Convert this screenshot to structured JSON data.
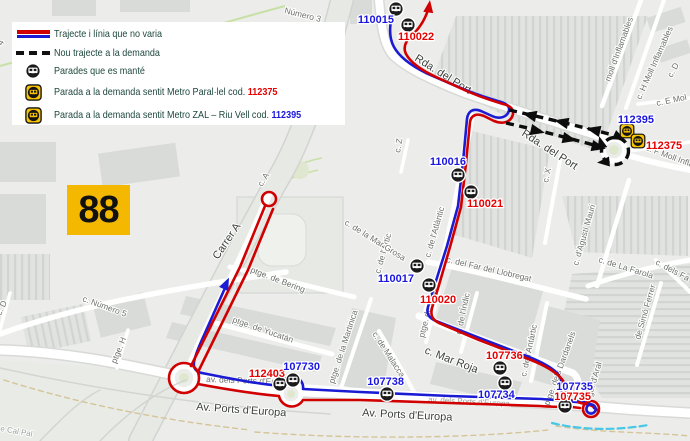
{
  "route_number": "88",
  "colors": {
    "line_red": "#d10000",
    "line_blue": "#1b1bd4",
    "label_red": "#e60000",
    "label_blue": "#1a16e0",
    "badge_yellow": "#f5b800",
    "legend_text": "#1d473c",
    "demand_black": "#0d0d0d",
    "demand_stop_yellow": "#f8c300"
  },
  "legend": {
    "items": [
      {
        "swatch": "double-line",
        "label": "Trajecte i línia que no varia"
      },
      {
        "swatch": "dashed-line",
        "label": "Nou trajecte a la demanda"
      },
      {
        "swatch": "kept-stop",
        "label": "Parades que es manté"
      },
      {
        "swatch": "demand-stop",
        "label": "Parada a la demanda sentit Metro Paral·lel cod. ",
        "code": "112375",
        "code_color": "#e60000"
      },
      {
        "swatch": "demand-stop",
        "label": "Parada a la demanda sentit Metro ZAL – Riu Vell cod. ",
        "code": "112395",
        "code_color": "#1a16e0"
      }
    ]
  },
  "map": {
    "stops": [
      {
        "code": "110015",
        "color": "blue",
        "type": "kept",
        "x": 396,
        "y": 9,
        "lx": 394,
        "ly": 23,
        "anchor": "end"
      },
      {
        "code": "110022",
        "color": "red",
        "type": "kept",
        "x": 408,
        "y": 25,
        "lx": 398,
        "ly": 40,
        "anchor": "start"
      },
      {
        "code": "110016",
        "color": "blue",
        "type": "kept",
        "x": 458,
        "y": 175,
        "lx": 466,
        "ly": 165,
        "anchor": "end"
      },
      {
        "code": "110021",
        "color": "red",
        "type": "kept",
        "x": 471,
        "y": 192,
        "lx": 467,
        "ly": 207,
        "anchor": "start"
      },
      {
        "code": "110017",
        "color": "blue",
        "type": "kept",
        "x": 417,
        "y": 266,
        "lx": 414,
        "ly": 282,
        "anchor": "end"
      },
      {
        "code": "110020",
        "color": "red",
        "type": "kept",
        "x": 429,
        "y": 285,
        "lx": 420,
        "ly": 303,
        "anchor": "start"
      },
      {
        "code": "107736",
        "color": "red",
        "type": "kept",
        "x": 500,
        "y": 368,
        "lx": 486,
        "ly": 359,
        "anchor": "start"
      },
      {
        "code": "107734",
        "color": "blue",
        "type": "kept",
        "x": 505,
        "y": 383,
        "lx": 478,
        "ly": 398,
        "anchor": "start"
      },
      {
        "code": "107738",
        "color": "blue",
        "type": "kept",
        "x": 387,
        "y": 394,
        "lx": 404,
        "ly": 385,
        "anchor": "end"
      },
      {
        "code": "112403",
        "color": "red",
        "type": "kept",
        "x": 280,
        "y": 384,
        "lx": 285,
        "ly": 377,
        "anchor": "end"
      },
      {
        "code": "107730",
        "color": "blue",
        "type": "kept",
        "x": 293,
        "y": 380,
        "lx": 320,
        "ly": 370,
        "anchor": "end"
      },
      {
        "code": "107735",
        "color": "blue",
        "type": "none",
        "x": 565,
        "y": 406,
        "lx": 593,
        "ly": 390,
        "anchor": "end",
        "no_icon": true
      },
      {
        "code": "107735",
        "color": "red",
        "type": "kept",
        "x": 565,
        "y": 406,
        "lx": 591,
        "ly": 400,
        "anchor": "end"
      },
      {
        "code": "112395",
        "color": "blue",
        "type": "demand",
        "x": 627,
        "y": 131,
        "lx": 654,
        "ly": 123,
        "anchor": "end"
      },
      {
        "code": "112375",
        "color": "red",
        "type": "demand",
        "x": 638,
        "y": 141,
        "lx": 646,
        "ly": 149,
        "anchor": "start"
      }
    ],
    "street_labels": [
      {
        "t": "Número 3",
        "x": 284,
        "y": 13,
        "r": 14,
        "c": "sm"
      },
      {
        "t": "4",
        "x": 2,
        "y": 46,
        "r": -60,
        "c": "sm"
      },
      {
        "t": "Rda. del Port",
        "x": 414,
        "y": 60,
        "r": 32,
        "c": "lg"
      },
      {
        "t": "Rda. del Port",
        "x": 521,
        "y": 135,
        "r": 33,
        "c": "lg"
      },
      {
        "t": "moll d'Inflamables",
        "x": 610,
        "y": 82,
        "r": -70,
        "c": "sm"
      },
      {
        "t": "c. H Moll Inflamables",
        "x": 641,
        "y": 100,
        "r": -66,
        "c": "sm"
      },
      {
        "t": "c. D",
        "x": 672,
        "y": 78,
        "r": -62,
        "c": "sm"
      },
      {
        "t": "c. E Mol",
        "x": 657,
        "y": 106,
        "r": -12,
        "c": "sm"
      },
      {
        "t": "c. F Moll Infla",
        "x": 645,
        "y": 150,
        "r": 20,
        "c": "sm"
      },
      {
        "t": "c. X",
        "x": 548,
        "y": 183,
        "r": -78,
        "c": "sm"
      },
      {
        "t": "c. Z",
        "x": 400,
        "y": 153,
        "r": -80,
        "c": "sm"
      },
      {
        "t": "c. d'Agustí Mauri",
        "x": 578,
        "y": 266,
        "r": -74,
        "c": "sm"
      },
      {
        "t": "c. de La Farola",
        "x": 598,
        "y": 262,
        "r": 17,
        "c": "sm"
      },
      {
        "t": "c. dels Fa",
        "x": 655,
        "y": 264,
        "r": 28,
        "c": "sm"
      },
      {
        "t": "de Simó Ferrer",
        "x": 640,
        "y": 340,
        "r": -74,
        "c": "sm"
      },
      {
        "t": "c. de l'Atlàntic",
        "x": 430,
        "y": 258,
        "r": -74,
        "c": "sm"
      },
      {
        "t": "c. de l'Artic",
        "x": 380,
        "y": 274,
        "r": -74,
        "c": "sm"
      },
      {
        "t": "c. de la Mar Grosa",
        "x": 344,
        "y": 224,
        "r": 32,
        "c": "sm"
      },
      {
        "t": "c. del Far del Llobregat",
        "x": 446,
        "y": 262,
        "r": 13,
        "c": "sm"
      },
      {
        "t": "ptge. de Suez",
        "x": 424,
        "y": 338,
        "r": -76,
        "c": "sm"
      },
      {
        "t": "c. de l'Índic",
        "x": 461,
        "y": 335,
        "r": -78,
        "c": "sm"
      },
      {
        "t": "c. de l'Antàrtic",
        "x": 526,
        "y": 377,
        "r": -78,
        "c": "sm"
      },
      {
        "t": "c. Mar Roja",
        "x": 424,
        "y": 353,
        "r": 21,
        "c": "lg"
      },
      {
        "t": "c. de Malacca",
        "x": 372,
        "y": 334,
        "r": 57,
        "c": "sm"
      },
      {
        "t": "ptge. de la Martinica",
        "x": 334,
        "y": 384,
        "r": -72,
        "c": "sm"
      },
      {
        "t": "ptge. de Bering",
        "x": 250,
        "y": 272,
        "r": 21,
        "c": "sm"
      },
      {
        "t": "ptge. de Yucatán",
        "x": 232,
        "y": 322,
        "r": 19,
        "c": "sm"
      },
      {
        "t": "Carrer A",
        "x": 218,
        "y": 260,
        "r": -56,
        "c": "lg"
      },
      {
        "t": "c. A",
        "x": 262,
        "y": 187,
        "r": -58,
        "c": "sm"
      },
      {
        "t": "c. Número 5",
        "x": 82,
        "y": 301,
        "r": 20,
        "c": "sm"
      },
      {
        "t": "ptge. H",
        "x": 116,
        "y": 364,
        "r": -68,
        "c": "sm"
      },
      {
        "t": "c. D",
        "x": 1,
        "y": 316,
        "r": -66,
        "c": "sm"
      },
      {
        "t": "e Cal Pal",
        "x": 0,
        "y": 431,
        "r": 10,
        "c": "faint"
      },
      {
        "t": "av. dels Ports d'Europa",
        "x": 206,
        "y": 382,
        "r": 2,
        "c": "sm"
      },
      {
        "t": "av. dels Ports d'Europa",
        "x": 428,
        "y": 402,
        "r": 3,
        "c": "faint"
      },
      {
        "t": "Av. Ports d'Europa",
        "x": 196,
        "y": 410,
        "r": 4,
        "c": "lg"
      },
      {
        "t": "Av. Ports d'Europa",
        "x": 362,
        "y": 416,
        "r": 3,
        "c": "lg"
      },
      {
        "t": "ptge. d'Aral",
        "x": 590,
        "y": 404,
        "r": -74,
        "c": "sm"
      },
      {
        "t": "ptge. dels Dardanels",
        "x": 549,
        "y": 406,
        "r": -70,
        "c": "sm"
      }
    ]
  }
}
